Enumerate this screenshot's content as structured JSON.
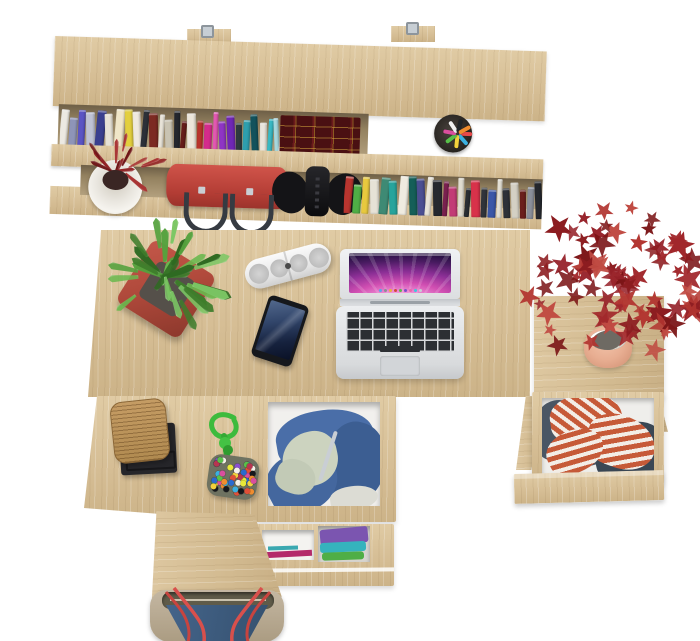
{
  "scene": {
    "description": "Top-down product view of a light sonoma-oak desk set: wall shelf with books and accessories, desk with laptop, smartphone, speaker and plants, open drawers with clothes, tote bag below"
  },
  "palette": {
    "background": "#ffffff",
    "wood": "#d9c39c",
    "wood_shadow": "#c6ad82",
    "shelf_interior": "#8f7d60",
    "accent_red": "#b23530",
    "accent_green": "#55a23e"
  },
  "labels": {
    "shelf_unit": "wall shelf with books",
    "handbag": "red handbag",
    "headphones": "black headphones",
    "pen_cup": "pen cup",
    "shelf_plant": "small red plant in white pot",
    "laptop": "silver laptop with purple wallpaper",
    "phone": "smartphone",
    "speaker": "white pill speaker",
    "green_plant": "green plant in red square pot",
    "maple_plant": "red maple plant in clay pot",
    "right_drawer": "open drawer with striped shirt and jeans",
    "center_drawer": "open drawer with blue hoodie",
    "lower_drawer": "drawer with folded clothes",
    "storage_box": "woven box on black tray",
    "rope_toy": "green rope with beaded pouch",
    "tote_bag": "blue and beige tote bag"
  },
  "hutch": {
    "mount_hook_count": 2,
    "books_top": [
      "#ece9e2",
      "#8e94b8",
      "#5b54c4",
      "#bfc2d4",
      "#3a3f8f",
      "#e7e2d6",
      "#f0e6c8",
      "#e3cf3e",
      "#efe9de",
      "#2c3038",
      "#7c2a22",
      "#e8e3d8",
      "#c9c3b2",
      "#24272e",
      "#661d1a",
      "#ece6da",
      "#b8342c",
      "#d42b8c",
      "#e358b2",
      "#8f35c4",
      "#6f27b5",
      "#2f3a3f",
      "#2e9fae",
      "#12525c",
      "#e9e5dc",
      "#39b9c4",
      "#a7d8de",
      "#f1ece2",
      "#262a31",
      "#515660",
      "#1e2126",
      "#5e2f8e",
      "#2b2e35"
    ],
    "books_bottom": [
      "#b8352f",
      "#4fae46",
      "#e8c93e",
      "#e6e2d6",
      "#3e8a74",
      "#27a49c",
      "#efebe0",
      "#155f58",
      "#4b4f93",
      "#e8e4d9",
      "#26292f",
      "#7b2150",
      "#c23b76",
      "#e0dcd0",
      "#2a2e33",
      "#d8324a",
      "#30343b",
      "#3b57a8",
      "#e4e0d5",
      "#2e3138",
      "#d4d0c4",
      "#6b1f1c",
      "#8a8f9a",
      "#24272d"
    ],
    "leather_books": {
      "base": "#4a1012",
      "trim": "#c9a03c"
    },
    "pen_cup": {
      "cup": "#2e2a26",
      "pens": [
        "#e84a4a",
        "#3bb0e0",
        "#f2d13c",
        "#58c04a",
        "#d94f9e",
        "#f0f0f0",
        "#202428",
        "#f08c2e"
      ]
    },
    "shelf_plant_leaves": {
      "count": 14,
      "min": 18,
      "max": 30,
      "ratio": 0.2,
      "radial": true,
      "palette": [
        "#8f1d20",
        "#a83434",
        "#6e1416"
      ]
    },
    "handbag": {
      "body": "#c7463e",
      "handles": "#3a3f46"
    },
    "headphones": {
      "color": "#141416"
    }
  },
  "desk": {
    "laptop": {
      "wallpaper": [
        "#fbe3f2",
        "#f090d6",
        "#d14fb2",
        "#8c2f96",
        "#4a1b62",
        "#180a30"
      ],
      "body": "#e6e8ea",
      "keys": "#2c2f33",
      "dock_dots": [
        "#5aa7e8",
        "#8a8f96",
        "#e8b43a",
        "#d1483e",
        "#58b94c",
        "#7a50c8",
        "#e86aa8",
        "#3ccadd",
        "#c9ced4"
      ]
    },
    "phone": {
      "body": "#16181c",
      "screen_top": "#52688c",
      "screen_bottom": "#0a1126"
    },
    "speaker": {
      "body": "#f2f2f2",
      "grille": "#c9c9c9"
    },
    "green_plant": {
      "pot": "#b14a3c",
      "leaves": {
        "count": 30,
        "min": 24,
        "max": 42,
        "ratio": 0.28,
        "radial": true,
        "palette": [
          "#55a23e",
          "#3f7d2c",
          "#6ab84e",
          "#2f6a22",
          "#7cc765"
        ]
      }
    }
  },
  "side_table": {
    "maple_plant": {
      "pot": "#e8ae92",
      "soil": "#6e6a63",
      "leaves": {
        "count": 80,
        "min": 12,
        "max": 30,
        "ratio": 1,
        "star": true,
        "palette": [
          "#a1272b",
          "#8c1c20",
          "#b23530",
          "#7a1315",
          "#c04a42",
          "#96222a"
        ]
      }
    }
  },
  "drawers": {
    "right": {
      "jeans": "#4a5664",
      "jeans_dark": "#3a4754",
      "shirt_stripe_light": "#f3ede6",
      "shirt_stripe_red": "#c65a38"
    },
    "center": {
      "hoodie": "#4a6ea8",
      "hoodie_dark": "#3c5e92",
      "hoodie_mid": "#44679e",
      "lining": "#ccd3bf",
      "cloth": "#dcdcd4"
    },
    "lower": {
      "folded": [
        "#7b55b0",
        "#35b3bd",
        "#4fae46"
      ],
      "strip": "#b42a6a"
    }
  },
  "accessories": {
    "storage_box": {
      "body": "#b9905a",
      "tray": "#26262a"
    },
    "rope_toy": {
      "rope": "#3dbb3d",
      "pouch": "#6e7261",
      "beads": {
        "count": 46,
        "palette": [
          "#d94f9e",
          "#f2d13c",
          "#3bb0e0",
          "#e05038",
          "#58c04a",
          "#8a4fd0",
          "#f08c2e",
          "#f5f0e8",
          "#2a6ad0",
          "#16181c",
          "#e8e838",
          "#b83550"
        ]
      }
    },
    "tote_bag": {
      "body": "#bcae98",
      "panel": "#3d5c80",
      "straps": "#d8504c",
      "lining": "#5f5b49"
    }
  }
}
